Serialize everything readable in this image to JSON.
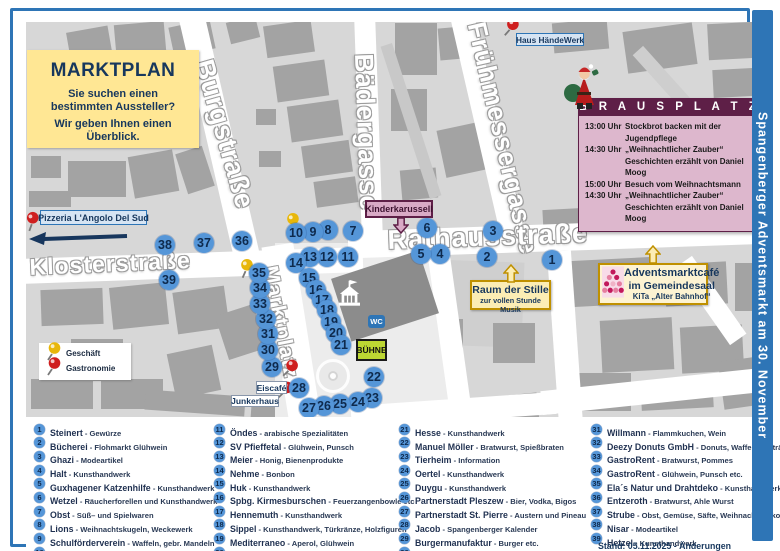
{
  "colors": {
    "frame_blue": "#2e75b6",
    "marker_blue": "#5596d8",
    "marker_text": "#0e2a4d",
    "maroon": "#5e1f47",
    "pink": "#ddb7cd",
    "gold": "#bf9000",
    "box_yellow": "#ffe794",
    "light_gold": "#fcedb4",
    "stage_green": "#bdd733",
    "label_blue_bg": "#d6e4f3",
    "pin_red": "#cf1f1f",
    "pin_yellow": "#e8b70a"
  },
  "title_box": {
    "title": "MARKTPLAN",
    "line1": "Sie suchen einen bestimmten Aussteller?",
    "line2": "Wir geben Ihnen einen Überblick."
  },
  "banner": {
    "text": "Spangenberger Adventsmarkt am 30. November"
  },
  "footer": {
    "stand": "Stand: 05.11.2025 - Änderungen vorbehalten"
  },
  "key": {
    "geschaeft": "Geschäft",
    "gastronomie": "Gastronomie"
  },
  "labels": {
    "pizzeria": "Pizzeria  L'Angolo Del Sud",
    "haus_haendewerk": "Haus HändeWerk",
    "kinderkarussell": "Kinderkarussell",
    "eiscafe": "Eiscafé",
    "junkerhaus": "Junkerhaus",
    "buehne": "BÜHNE",
    "wc": "WC",
    "raum_title": "Raum der Stille",
    "raum_sub": "zur vollen Stunde Musik",
    "cafe_line1": "Adventsmarktcafé",
    "cafe_line2": "im Gemeindesaal",
    "cafe_line3": "KiTa „Alter Bahnhof“"
  },
  "brausplatz": {
    "title": "B R A U S P L A T Z",
    "schedule": [
      {
        "time": "13:00 Uhr",
        "text": "Stockbrot backen mit der"
      },
      {
        "time": "",
        "text": "Jugendpflege"
      },
      {
        "time": "14:30 Uhr",
        "text": "„Weihnachtlicher Zauber“"
      },
      {
        "time": "",
        "text": "Geschichten erzählt von Daniel Moog"
      },
      {
        "time": "15:00 Uhr",
        "text": "Besuch vom Weihnachtsmann"
      },
      {
        "time": "14:30 Uhr",
        "text": "„Weihnachtlicher Zauber“"
      },
      {
        "time": "",
        "text": "Geschichten erzählt von Daniel Moog"
      }
    ]
  },
  "map": {
    "streets": [
      {
        "name": "Burgstraße",
        "x": 205,
        "y": 45,
        "rot": 74,
        "size": 27
      },
      {
        "name": "Bädergasse",
        "x": 366,
        "y": 42,
        "rot": 88,
        "size": 26
      },
      {
        "name": "Frühmessergasse",
        "x": 478,
        "y": 8,
        "rot": 77,
        "size": 26
      },
      {
        "name": "Rathausstraße",
        "x": 374,
        "y": 214,
        "rot": -2,
        "size": 27
      },
      {
        "name": "Klosterstraße",
        "x": 16,
        "y": 243,
        "rot": -2.5,
        "size": 23
      },
      {
        "name": "Marktplatz",
        "x": 268,
        "y": 253,
        "rot": 79,
        "size": 21
      }
    ],
    "markers": [
      {
        "n": 1,
        "x": 539,
        "y": 249
      },
      {
        "n": 2,
        "x": 474,
        "y": 246
      },
      {
        "n": 3,
        "x": 480,
        "y": 220
      },
      {
        "n": 4,
        "x": 427,
        "y": 243
      },
      {
        "n": 5,
        "x": 408,
        "y": 243
      },
      {
        "n": 6,
        "x": 414,
        "y": 217
      },
      {
        "n": 7,
        "x": 340,
        "y": 220
      },
      {
        "n": 8,
        "x": 315,
        "y": 219
      },
      {
        "n": 9,
        "x": 300,
        "y": 221
      },
      {
        "n": 10,
        "x": 283,
        "y": 222
      },
      {
        "n": 11,
        "x": 335,
        "y": 246
      },
      {
        "n": 12,
        "x": 314,
        "y": 246
      },
      {
        "n": 13,
        "x": 297,
        "y": 246
      },
      {
        "n": 14,
        "x": 283,
        "y": 252
      },
      {
        "n": 15,
        "x": 296,
        "y": 267
      },
      {
        "n": 16,
        "x": 303,
        "y": 279
      },
      {
        "n": 17,
        "x": 309,
        "y": 289
      },
      {
        "n": 18,
        "x": 314,
        "y": 299
      },
      {
        "n": 19,
        "x": 318,
        "y": 311
      },
      {
        "n": 20,
        "x": 323,
        "y": 322
      },
      {
        "n": 21,
        "x": 328,
        "y": 334
      },
      {
        "n": 22,
        "x": 361,
        "y": 366
      },
      {
        "n": 23,
        "x": 359,
        "y": 387
      },
      {
        "n": 24,
        "x": 345,
        "y": 391
      },
      {
        "n": 25,
        "x": 327,
        "y": 393
      },
      {
        "n": 26,
        "x": 311,
        "y": 395
      },
      {
        "n": 27,
        "x": 296,
        "y": 397
      },
      {
        "n": 28,
        "x": 286,
        "y": 377
      },
      {
        "n": 29,
        "x": 259,
        "y": 356
      },
      {
        "n": 30,
        "x": 255,
        "y": 339
      },
      {
        "n": 31,
        "x": 255,
        "y": 323
      },
      {
        "n": 32,
        "x": 253,
        "y": 308
      },
      {
        "n": 33,
        "x": 247,
        "y": 293
      },
      {
        "n": 34,
        "x": 247,
        "y": 277
      },
      {
        "n": 35,
        "x": 246,
        "y": 262
      },
      {
        "n": 36,
        "x": 229,
        "y": 230
      },
      {
        "n": 37,
        "x": 191,
        "y": 232
      },
      {
        "n": 38,
        "x": 152,
        "y": 234
      },
      {
        "n": 39,
        "x": 156,
        "y": 269
      }
    ],
    "pins": [
      {
        "color": "red",
        "x": 11,
        "y": 200,
        "rot": -14
      },
      {
        "color": "red",
        "x": 490,
        "y": 6,
        "rot": 8
      },
      {
        "color": "yellow",
        "x": 271,
        "y": 201,
        "rot": -10
      },
      {
        "color": "yellow",
        "x": 225,
        "y": 247,
        "rot": -10
      },
      {
        "color": "red",
        "x": 269,
        "y": 347,
        "rot": 12
      },
      {
        "color": "red",
        "x": 264,
        "y": 369,
        "rot": 12
      }
    ]
  },
  "vendors": [
    {
      "n": 1,
      "name": "Steinert",
      "desc": "Gewürze"
    },
    {
      "n": 2,
      "name": "Bücherei",
      "desc": "Flohmarkt Glühwein"
    },
    {
      "n": 3,
      "name": "Ghazi",
      "desc": "Modeartikel"
    },
    {
      "n": 4,
      "name": "Halt",
      "desc": "Kunsthandwerk"
    },
    {
      "n": 5,
      "name": "Guxhagener Katzenhilfe",
      "desc": "Kunsthandwerk"
    },
    {
      "n": 6,
      "name": "Wetzel",
      "desc": "Räucherforellen und Kunsthandwerk"
    },
    {
      "n": 7,
      "name": "Obst",
      "desc": "Süß– und Spielwaren"
    },
    {
      "n": 8,
      "name": "Lions",
      "desc": "Weihnachtskugeln, Weckewerk"
    },
    {
      "n": 9,
      "name": "Schulförderverein",
      "desc": "Waffeln, gebr. Mandeln"
    },
    {
      "n": 10,
      "name": "Lisa Marie",
      "desc": "Dekoartikel und mehr (Geschäft)"
    },
    {
      "n": 11,
      "name": "Öndes",
      "desc": "arabische Spezialitäten"
    },
    {
      "n": 12,
      "name": "SV Pfieffetal",
      "desc": "Glühwein, Punsch"
    },
    {
      "n": 13,
      "name": "Meier",
      "desc": "Honig, Bienenprodukte"
    },
    {
      "n": 14,
      "name": "Nehme",
      "desc": "Bonbon"
    },
    {
      "n": 15,
      "name": "Huk",
      "desc": "Kunsthandwerk"
    },
    {
      "n": 16,
      "name": "Spbg. Kirmesburschen",
      "desc": "Feuerzangenbowle etc"
    },
    {
      "n": 17,
      "name": "Hennemuth",
      "desc": "Kunsthandwerk"
    },
    {
      "n": 18,
      "name": "Sippel",
      "desc": "Kunsthandwerk, Türkränze, Holzfiguren"
    },
    {
      "n": 19,
      "name": "Mediterraneo",
      "desc": "Aperol, Glühwein"
    },
    {
      "n": 20,
      "name": "Apolle",
      "desc": "thailändische Spezialitäten"
    },
    {
      "n": 21,
      "name": "Hesse",
      "desc": "Kunsthandwerk"
    },
    {
      "n": 22,
      "name": "Manuel Möller",
      "desc": "Bratwurst, Spießbraten"
    },
    {
      "n": 23,
      "name": "Tierheim",
      "desc": "Information"
    },
    {
      "n": 24,
      "name": "Oertel",
      "desc": "Kunsthandwerk"
    },
    {
      "n": 25,
      "name": "Duygu",
      "desc": "Kunsthandwerk"
    },
    {
      "n": 26,
      "name": "Partnerstadt Pleszew",
      "desc": "Bier, Vodka, Bigos"
    },
    {
      "n": 27,
      "name": "Partnerstadt St. Pierre",
      "desc": "Austern und Pineau"
    },
    {
      "n": 28,
      "name": "Jacob",
      "desc": "Spangenberger Kalender"
    },
    {
      "n": 29,
      "name": "Burgermanufaktur",
      "desc": "Burger etc."
    },
    {
      "n": 30,
      "name": "Combibo",
      "desc": "Cocktails"
    },
    {
      "n": 31,
      "name": "Willmann",
      "desc": "Flammkuchen, Wein"
    },
    {
      "n": 32,
      "name": "Deezy Donuts GmbH",
      "desc": "Donuts, Waffeln, Getränke"
    },
    {
      "n": 33,
      "name": "GastroRent",
      "desc": "Bratwurst, Pommes"
    },
    {
      "n": 34,
      "name": "GastroRent",
      "desc": "Glühwein, Punsch  etc."
    },
    {
      "n": 35,
      "name": "Ela´s Natur und Drahtdeko",
      "desc": "Kunsthandwerk"
    },
    {
      "n": 36,
      "name": "Entzeroth",
      "desc": "Bratwurst, Ahle Wurst"
    },
    {
      "n": 37,
      "name": "Strube",
      "desc": "Obst, Gemüse, Säfte, Weihnachtsdeko"
    },
    {
      "n": 38,
      "name": "Nisar",
      "desc": "Modeartikel"
    },
    {
      "n": 39,
      "name": "Hetzel",
      "desc": "Kunsthandwerk"
    }
  ]
}
